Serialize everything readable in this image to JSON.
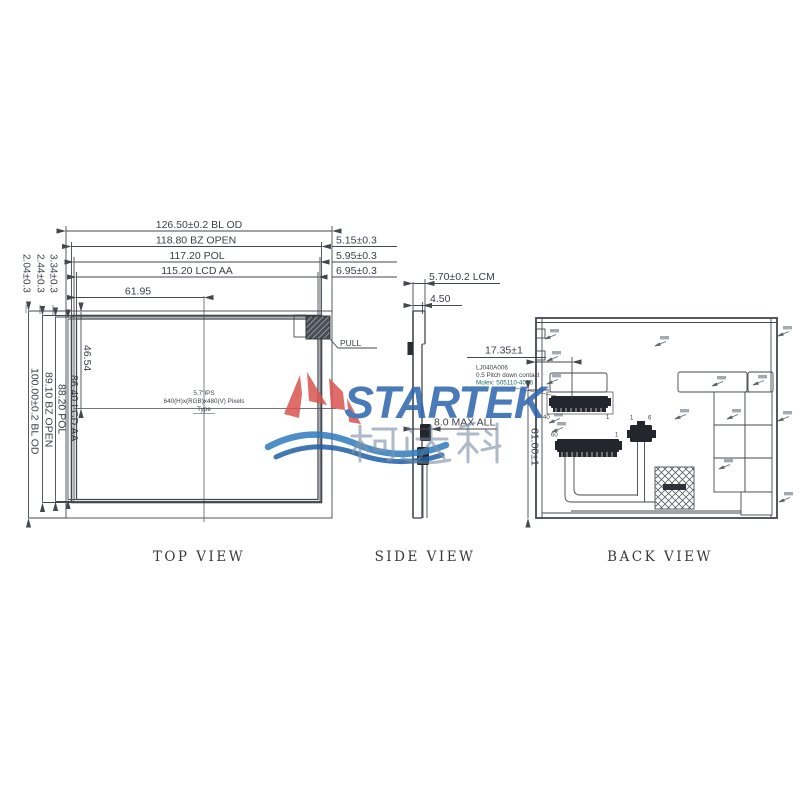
{
  "views": {
    "top": {
      "caption": "TOP VIEW",
      "dims_top": [
        "126.50±0.2 BL OD",
        "118.80 BZ OPEN",
        "117.20 POL",
        "115.20 LCD AA",
        "61.95"
      ],
      "dims_right": [
        "5.15±0.3",
        "5.95±0.3",
        "6.95±0.3"
      ],
      "dims_left": [
        "100.00±0.2 BL OD",
        "89.10 BZ OPEN",
        "88.20 POL",
        "86.40 LCD AA",
        "46.54"
      ],
      "dims_left_top": [
        "2.04±0.3",
        "2.44±0.3",
        "3.34±0.3"
      ],
      "center_note": [
        "5.7\"IPS",
        "640(H)x(RGB)x480(V) Pixels",
        "Type"
      ],
      "pull_label": "PULL"
    },
    "side": {
      "caption": "SIDE VIEW",
      "dim_thickness": "5.70±0.2 LCM",
      "dim_panel": "4.50",
      "dim_max": "8.0 MAX ALL",
      "dim_fpc": "17.35±1",
      "note": [
        "LJ040A006",
        "0.5 Pitch down contact",
        "Molex: 505110-4096"
      ]
    },
    "back": {
      "caption": "BACK VIEW",
      "dim_height": "61.00±1",
      "pins": {
        "upper_first": "40",
        "upper_last": "1",
        "lower_first": "60",
        "lower_last": "1",
        "bl_first": "1",
        "bl_last": "6"
      }
    }
  },
  "watermark": {
    "brand": "STARTEK",
    "chinese": "柯达科",
    "colors": {
      "red": "#d9534e",
      "blue": "#2b65ac",
      "wave_blue": "#2e7bc0",
      "gray_blue": "#6e819b"
    }
  }
}
